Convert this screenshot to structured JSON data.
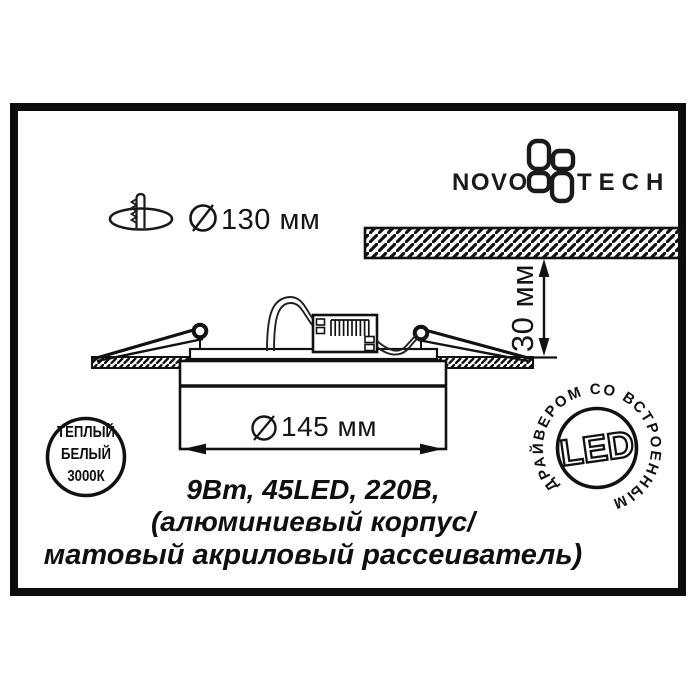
{
  "page": {
    "background": "#ffffff",
    "ink": "#111111"
  },
  "brand": {
    "name_left": "NOVO",
    "name_right": "TECH",
    "logo_icon": "novotech-pinwheel"
  },
  "installation": {
    "cutout_diameter": "130 мм",
    "recess_depth": "30 мм",
    "panel_diameter": "145 мм"
  },
  "specs": [
    "9Вт, 45LED, 220В,",
    "(алюминиевый корпус/",
    "матовый акриловый рассеиватель)"
  ],
  "badges": {
    "warm_white": {
      "lines": [
        "ТЕПЛЫЙ",
        "БЕЛЫЙ",
        "3000К"
      ]
    },
    "led_driver": {
      "center_label": "LED",
      "ring_label": "ДРАЙВЕРОМ СО ВСТРОЕННЫМ"
    }
  }
}
